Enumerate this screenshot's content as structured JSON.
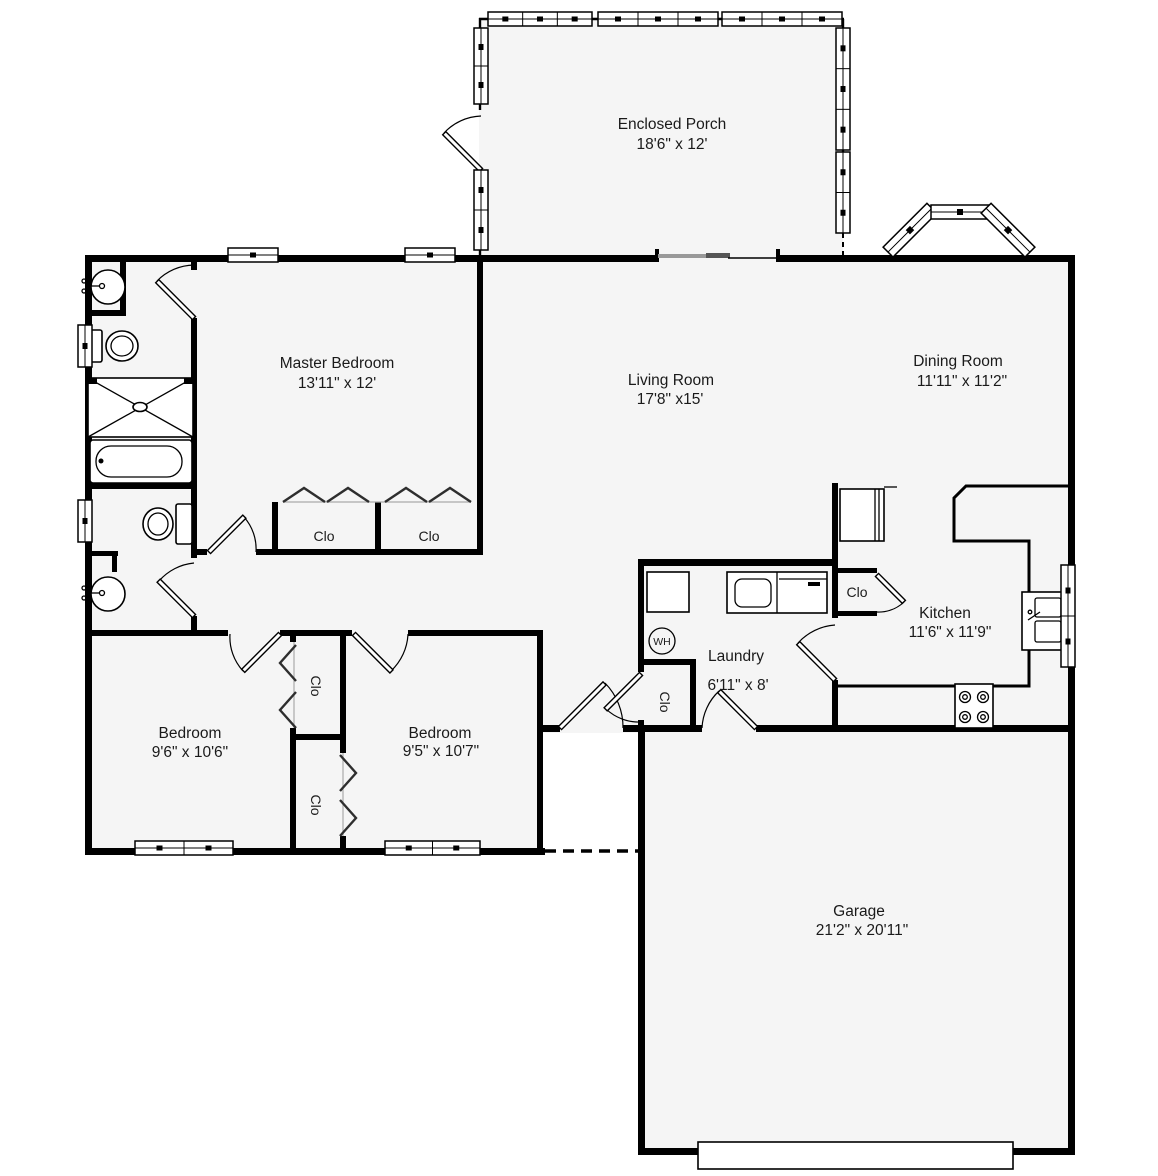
{
  "plan": {
    "rooms": {
      "enclosed_porch": {
        "name": "Enclosed Porch",
        "dims": "18'6\" x 12'"
      },
      "master_bedroom": {
        "name": "Master Bedroom",
        "dims": "13'11\" x 12'"
      },
      "living_room": {
        "name": "Living Room",
        "dims": "17'8\" x15'"
      },
      "dining_room": {
        "name": "Dining Room",
        "dims": "11'11\" x 11'2\""
      },
      "kitchen": {
        "name": "Kitchen",
        "dims": "11'6\" x 11'9\""
      },
      "laundry": {
        "name": "Laundry",
        "dims": "6'11\" x 8'"
      },
      "bedroom_left": {
        "name": "Bedroom",
        "dims": "9'6\" x 10'6\""
      },
      "bedroom_right": {
        "name": "Bedroom",
        "dims": "9'5\" x 10'7\""
      },
      "garage": {
        "name": "Garage",
        "dims": "21'2\" x 20'11\""
      }
    },
    "labels": {
      "closet": "Clo",
      "water_heater": "WH"
    },
    "colors": {
      "wall": "#000000",
      "interior_fill": "#f5f5f5",
      "background": "#ffffff",
      "text": "#1a1a1a"
    }
  }
}
